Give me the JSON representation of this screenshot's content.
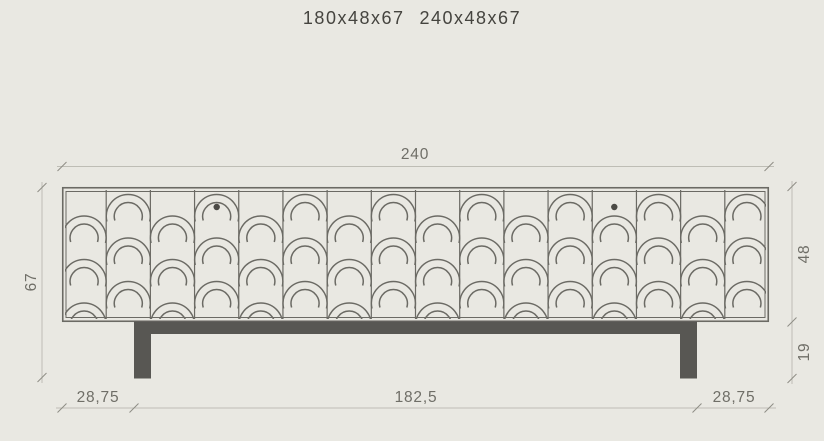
{
  "title": {
    "sizes": [
      "180x48x67",
      "240x48x67"
    ]
  },
  "colors": {
    "background": "#e9e8e2",
    "line_art": "#6b6a64",
    "dark_fill": "#585753",
    "dim_line": "#bebdb5",
    "dim_tick": "#8e8d85",
    "dim_text": "#6f6e67",
    "knob": "#4b4a45",
    "title_text": "#45443f"
  },
  "diagram": {
    "body": {
      "x": 62,
      "y": 187,
      "w": 707,
      "h": 135,
      "columns": 16,
      "scale_pitch": 43.5,
      "phase_even_offset": 29,
      "phase_odd_offset": 7.5,
      "outer_radius": 22,
      "inner_radius": 14
    },
    "knobs": [
      {
        "col": 3,
        "y": 207,
        "r": 3.2
      },
      {
        "col": 12,
        "y": 207,
        "r": 3.2
      }
    ],
    "base": {
      "rail": {
        "x": 134,
        "y": 321.5,
        "w": 563,
        "h": 12.5
      },
      "leg_w": 17,
      "leg_h": 57,
      "legs_x": [
        134,
        680
      ]
    },
    "dimensions": {
      "top": {
        "label": "240",
        "y": 166.5,
        "x1": 57,
        "x2": 774,
        "ticks": [
          62,
          769
        ],
        "label_x": 415,
        "label_y": 159
      },
      "bottom": {
        "y": 408,
        "x1": 56,
        "x2": 776,
        "ticks": [
          62,
          134,
          697,
          769
        ],
        "labels": [
          {
            "text": "28,75",
            "x": 98,
            "y": 402
          },
          {
            "text": "182,5",
            "x": 416,
            "y": 402
          },
          {
            "text": "28,75",
            "x": 734,
            "y": 402
          }
        ]
      },
      "left": {
        "label": "67",
        "x": 42,
        "y1": 182,
        "y2": 383,
        "ticks": [
          187.5,
          377.5
        ],
        "label_x": 36,
        "label_y": 282
      },
      "right": {
        "x": 792,
        "y1": 181,
        "y2": 384,
        "ticks": [
          186.5,
          322,
          378.5
        ],
        "labels": [
          {
            "text": "48",
            "x": 809,
            "y": 254
          },
          {
            "text": "19",
            "x": 809,
            "y": 352
          }
        ]
      }
    }
  }
}
